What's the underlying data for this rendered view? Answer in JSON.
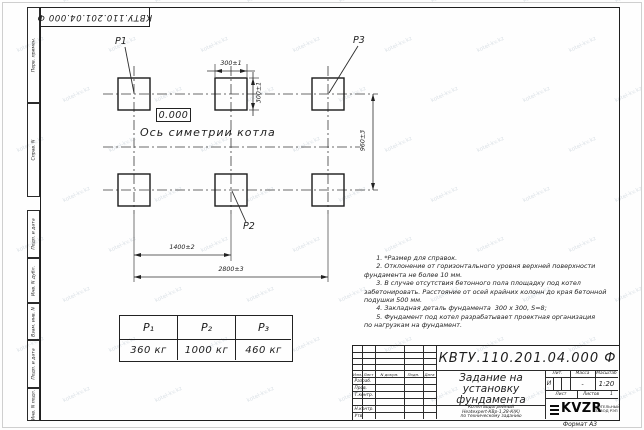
{
  "stamp_top": "КВТУ.110.201.04.000  Ф",
  "watermark": {
    "text": "kotel-kv.kz"
  },
  "margin_labels": [
    "Перв. примен.",
    "Справ. N",
    "Подп. и дата",
    "Инв. N дубл.",
    "Взам. инв. N",
    "Подп. и дата",
    "Инв. N подл."
  ],
  "drawing": {
    "p1": "P1",
    "p2": "P2",
    "p3": "P3",
    "level_mark": "0.000",
    "axis_label": "Ось симетрии котла",
    "dims": {
      "w300": "300±1",
      "h300": "300±1",
      "v960": "960±3",
      "d1400": "1400±2",
      "d2800": "2800±3"
    }
  },
  "notes": {
    "lines": [
      "      1. *Размер для справок.",
      "      2. Отклонение от горизонтального уровня верхней поверхности",
      "фундамента не более 10 мм.",
      "      3. В случае отсутствия бетонного пола площадку под котел",
      "забетонировать. Расстояние от осей крайних колонн до края бетонной",
      "подушки 500 мм.",
      "      4. Закладная деталь фундамента  300 х 300, S=8;",
      "      5. Фундамент под котел разрабатывает проектная организация",
      "по нагрузкам на фундамент."
    ]
  },
  "load_table": {
    "headers": [
      "P₁",
      "P₂",
      "P₃"
    ],
    "values": [
      "360 кг",
      "1000 кг",
      "460 кг"
    ]
  },
  "title_block": {
    "designation": "КВТУ.110.201.04.000  Ф",
    "title_lines": [
      "Задание на",
      "установку",
      "фундамента"
    ],
    "subtitle_lines": [
      "Котел водогрейный",
      "Heatexpert-КВр-1,28-К(К)",
      "по техническому заданию"
    ],
    "col_headers": [
      "Изм.",
      "Лист",
      "N докум.",
      "Подп.",
      "Дата"
    ],
    "rows": [
      "Разраб.",
      "Пров.",
      "Т.контр.",
      "",
      "Н.контр.",
      "Утв."
    ],
    "lit_label": "Лит.",
    "massa_label": "Масса",
    "masshtab_label": "Масштаб",
    "lit_value": "И",
    "massa_value": "-",
    "masshtab_value": "1:20",
    "list_label": "Лист",
    "listov_label": "Листов",
    "listov_value": "1",
    "logo_text": "KVZR",
    "logo_caption": [
      "КОТЕЛЬНЫЙ",
      "ЗАВОД РЭП"
    ],
    "format_label": "Формат А3"
  }
}
